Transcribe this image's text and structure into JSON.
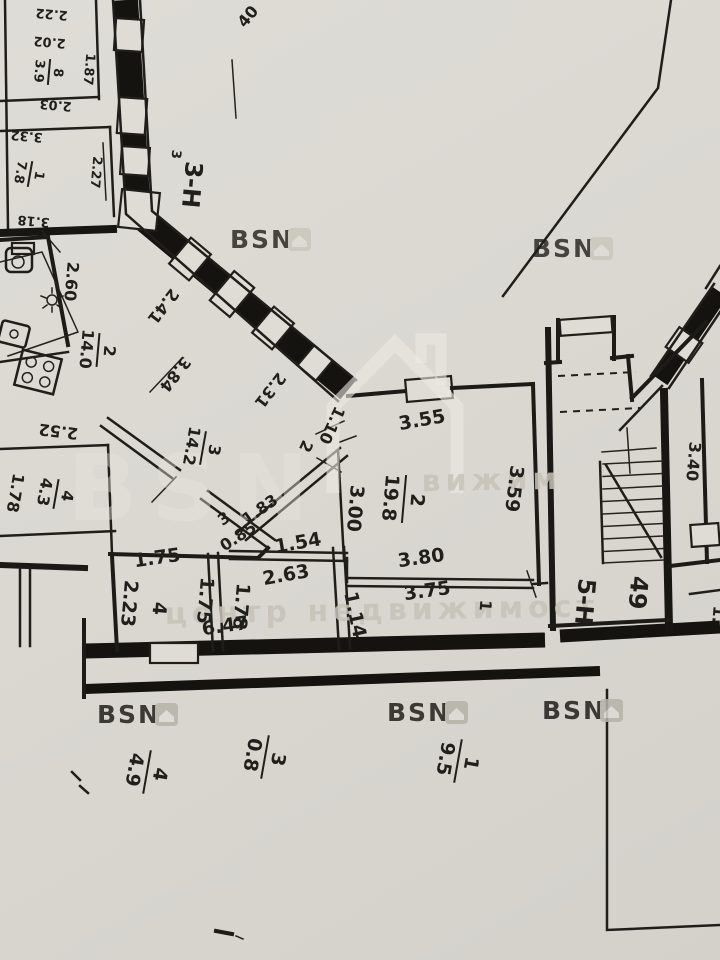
{
  "sheet": {
    "number": "40"
  },
  "units": {
    "unit3": {
      "label": "3-Н",
      "sup": "3"
    },
    "unit5": {
      "label": "5-Н"
    },
    "apartment": {
      "number": "49"
    },
    "right_partial": {
      "label": "1."
    }
  },
  "rooms": {
    "r8": {
      "num": "8",
      "area": "3.9"
    },
    "r1": {
      "num": "1",
      "area": "7.8"
    },
    "kitchen": {
      "num": "2",
      "area": "14.0"
    },
    "r3": {
      "num": "3",
      "area": "14.2"
    },
    "r4a": {
      "num": "4",
      "area": "4.3"
    },
    "main": {
      "num": "2",
      "area": "19.8"
    },
    "r4b": {
      "num": "4"
    },
    "hall": {
      "num": "3"
    },
    "c4": {
      "num": "4",
      "area": "4.9"
    },
    "c3": {
      "num": "3",
      "area": "0.8"
    },
    "c1": {
      "num": "1",
      "area": "9.5"
    }
  },
  "dimensions": {
    "d222": "2.22",
    "d202": "2.02",
    "d203": "2.03",
    "d187": "1.87",
    "d332": "3.32",
    "d318": "3.18",
    "d227": "2.27",
    "d260": "2.60",
    "d241": "2.41",
    "d384": "3.84",
    "d252": "2.52",
    "d231": "2.31",
    "d110": "1.10",
    "d2": "2",
    "d178l": "1.78",
    "d183": "1.83",
    "d085": "0.85",
    "d154": "1.54",
    "d263": "2.63",
    "d175a": "1.75",
    "d223": "2.23",
    "d175b": "1.75",
    "d178b": "1.78",
    "d114": "1.14",
    "d647": "6.47",
    "d300": "3.00",
    "d355": "3.55",
    "d359": "3.59",
    "d380": "3.80",
    "d375": "3.75",
    "d1": "1",
    "d340": "3.40"
  },
  "watermark": {
    "brand": "BSN",
    "tagline": "центр недвижимост",
    "fragment": "вижим"
  }
}
